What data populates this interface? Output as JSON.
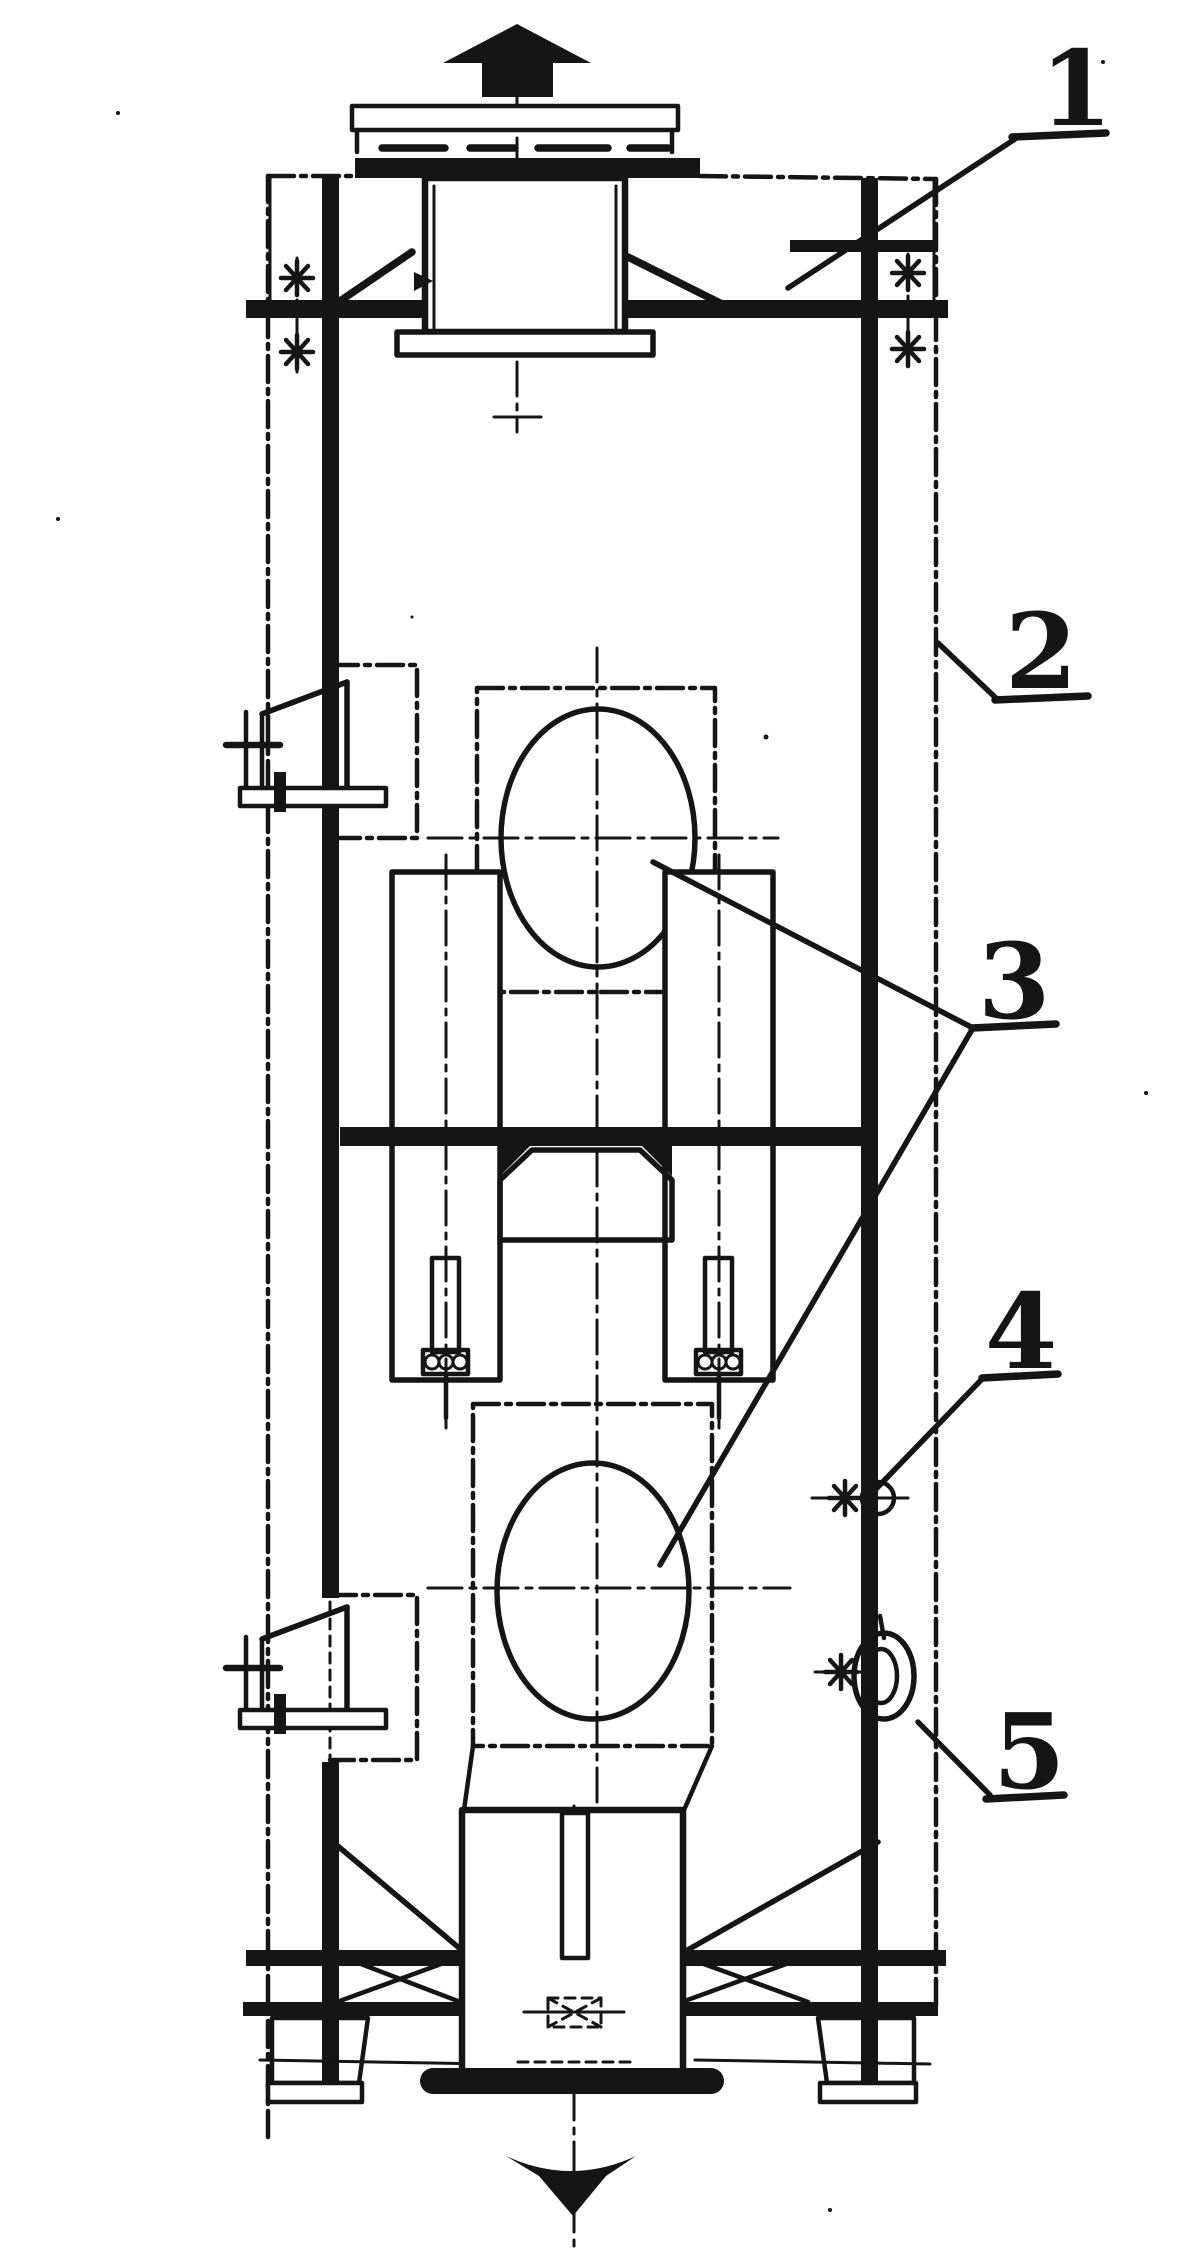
{
  "drawing": {
    "type": "engineering-assembly-drawing",
    "paper_color": "#ffffff",
    "ink_color": "#151515",
    "flow": {
      "top_arrow": "up",
      "bottom_arrow": "down"
    },
    "callouts": [
      {
        "label": "1",
        "points_to": "top-frame-brace"
      },
      {
        "label": "2",
        "points_to": "casing-phantom-outline"
      },
      {
        "label": "3",
        "points_to": "upper-and-lower-oval-rotors"
      },
      {
        "label": "4",
        "points_to": "side-fitting-upper"
      },
      {
        "label": "5",
        "points_to": "side-fitting-handwheel"
      }
    ],
    "icons": {
      "top": "up-arrow-icon",
      "bottom": "down-arrow-icon",
      "weld_marks": "asterisk-icon"
    }
  }
}
